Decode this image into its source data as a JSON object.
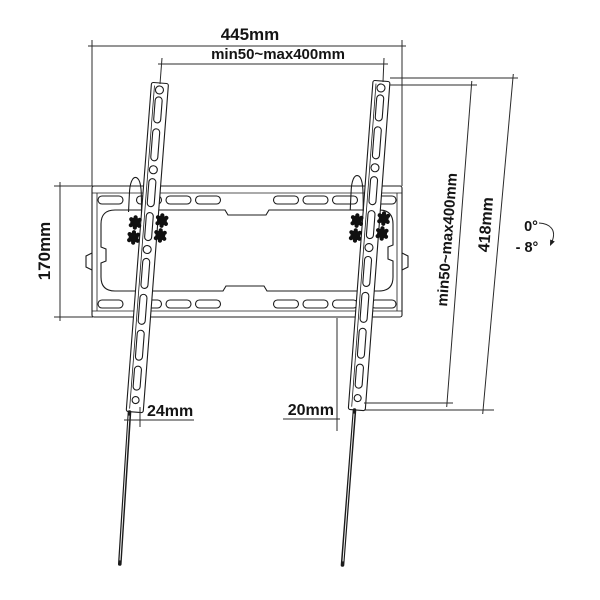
{
  "diagram": {
    "type": "technical-dimension-drawing",
    "subject": "tilting-tv-wall-mount",
    "dimensions": {
      "total_width": "445mm",
      "vesa_width_range": "min50~max400mm",
      "wall_plate_height": "170mm",
      "vesa_height_range": "min50~max400mm",
      "bracket_length": "418mm",
      "tilt_max": "0°",
      "tilt_min": "- 8°",
      "bottom_offset_left": "24mm",
      "bottom_offset_right": "20mm"
    },
    "colors": {
      "line": "#1c1c1c",
      "background": "#ffffff",
      "knob": "#101010"
    }
  }
}
